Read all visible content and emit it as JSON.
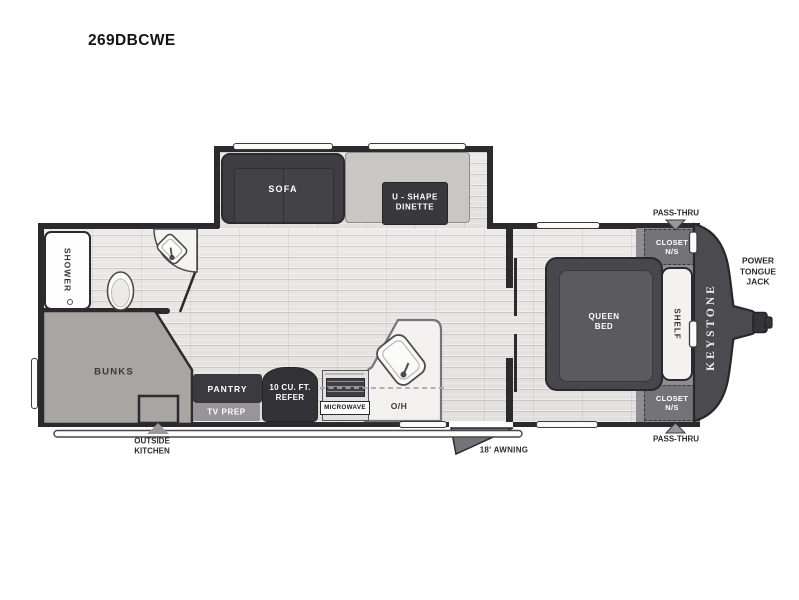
{
  "title": "269DBCWE",
  "colors": {
    "outline": "#2b2b2d",
    "furniture_dark": "#3a393d",
    "floor": "#e6e5e3",
    "bunks_gray": "#a8a5a2",
    "mid_gray": "#98969a",
    "nose_gray": "#4b4a4f",
    "white": "#ffffff"
  },
  "slideout": {
    "sofa": "SOFA",
    "dinette_line1": "U - SHAPE",
    "dinette_line2": "DINETTE"
  },
  "bath": {
    "shower": "SHOWER"
  },
  "rear": {
    "bunks": "BUNKS",
    "outside_kitchen_line1": "OUTSIDE",
    "outside_kitchen_line2": "KITCHEN"
  },
  "kitchen": {
    "pantry": "PANTRY",
    "tv_prep": "TV PREP",
    "refer_line1": "10 CU. FT.",
    "refer_line2": "REFER",
    "microwave": "MICROWAVE",
    "overhead": "O/H"
  },
  "bedroom": {
    "bed_line1": "QUEEN",
    "bed_line2": "BED",
    "shelf": "SHELF",
    "closet_top_line1": "CLOSET",
    "closet_top_line2": "N/S",
    "closet_bottom_line1": "CLOSET",
    "closet_bottom_line2": "N/S"
  },
  "exterior": {
    "awning": "18' AWNING",
    "pass_thru_top": "PASS-THRU",
    "pass_thru_bottom": "PASS-THRU",
    "jack_line1": "POWER",
    "jack_line2": "TONGUE",
    "jack_line3": "JACK",
    "brand": "KEYSTONE"
  }
}
